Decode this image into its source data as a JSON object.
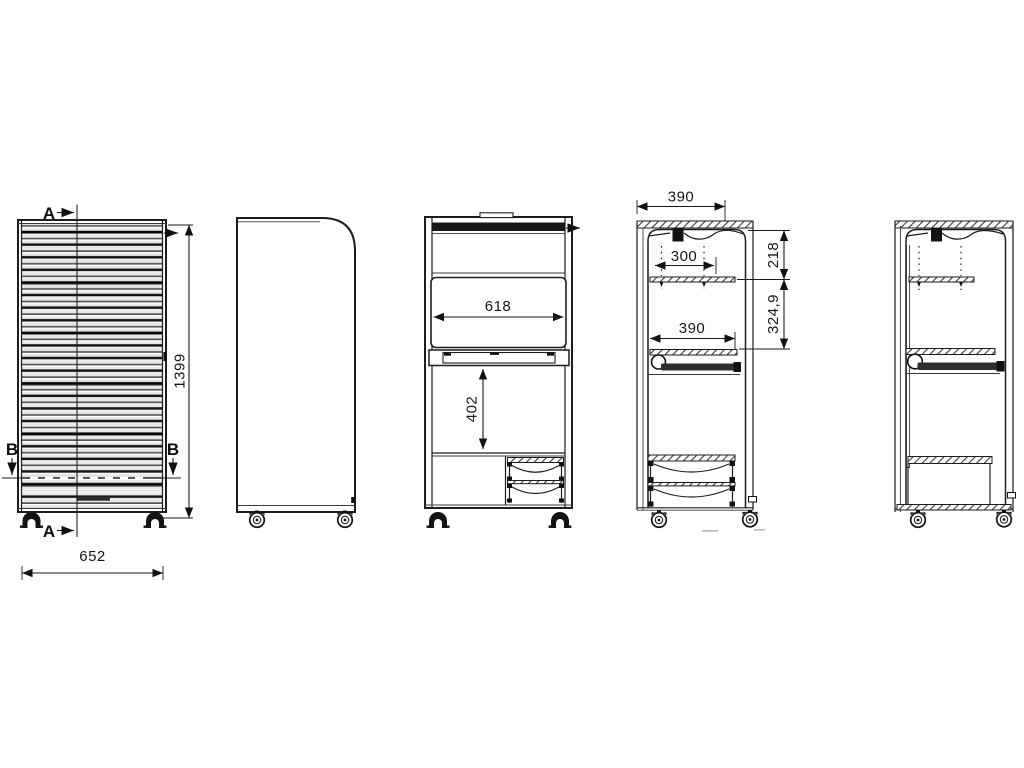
{
  "drawing": {
    "section_labels": {
      "a": "A",
      "b": "B"
    },
    "front_view": {
      "height": "1399",
      "width": "652"
    },
    "front_section_view": {
      "interior_width": "618",
      "knee_clearance": "402"
    },
    "side_section_view": {
      "top_depth": "390",
      "shelf_pin_span": "300",
      "top_to_shelf": "218",
      "shelf_to_tray": "324,9",
      "tray_depth": "390"
    }
  }
}
